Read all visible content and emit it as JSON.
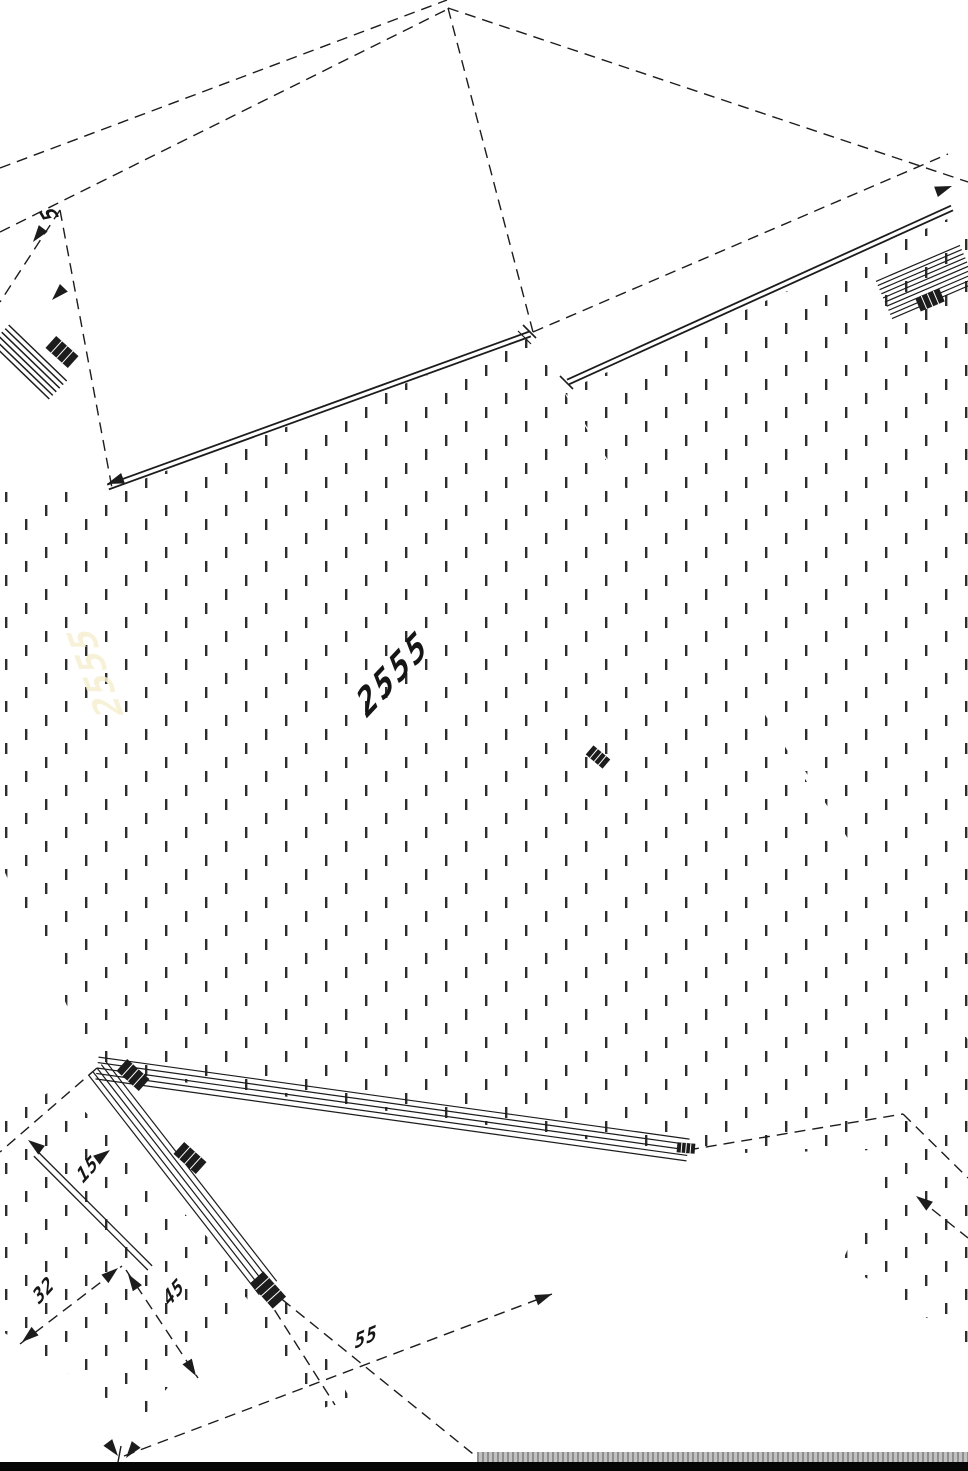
{
  "document": {
    "kind": "isometric CAD technical drawing (rotated sheet)",
    "line_color": "#1c1c1c",
    "background_color": "#ffffff"
  },
  "dimensions": {
    "main_length": "2555",
    "corner_top_left": "5",
    "detail_a": "15",
    "detail_b": "32",
    "detail_c": "45",
    "detail_d": "55"
  },
  "watermark": {
    "ghost_text": "2555",
    "ghost_color": "#f6efd2"
  },
  "footer": {
    "taskbar_color": "#060606",
    "strip_color": "#b0b0b0"
  }
}
